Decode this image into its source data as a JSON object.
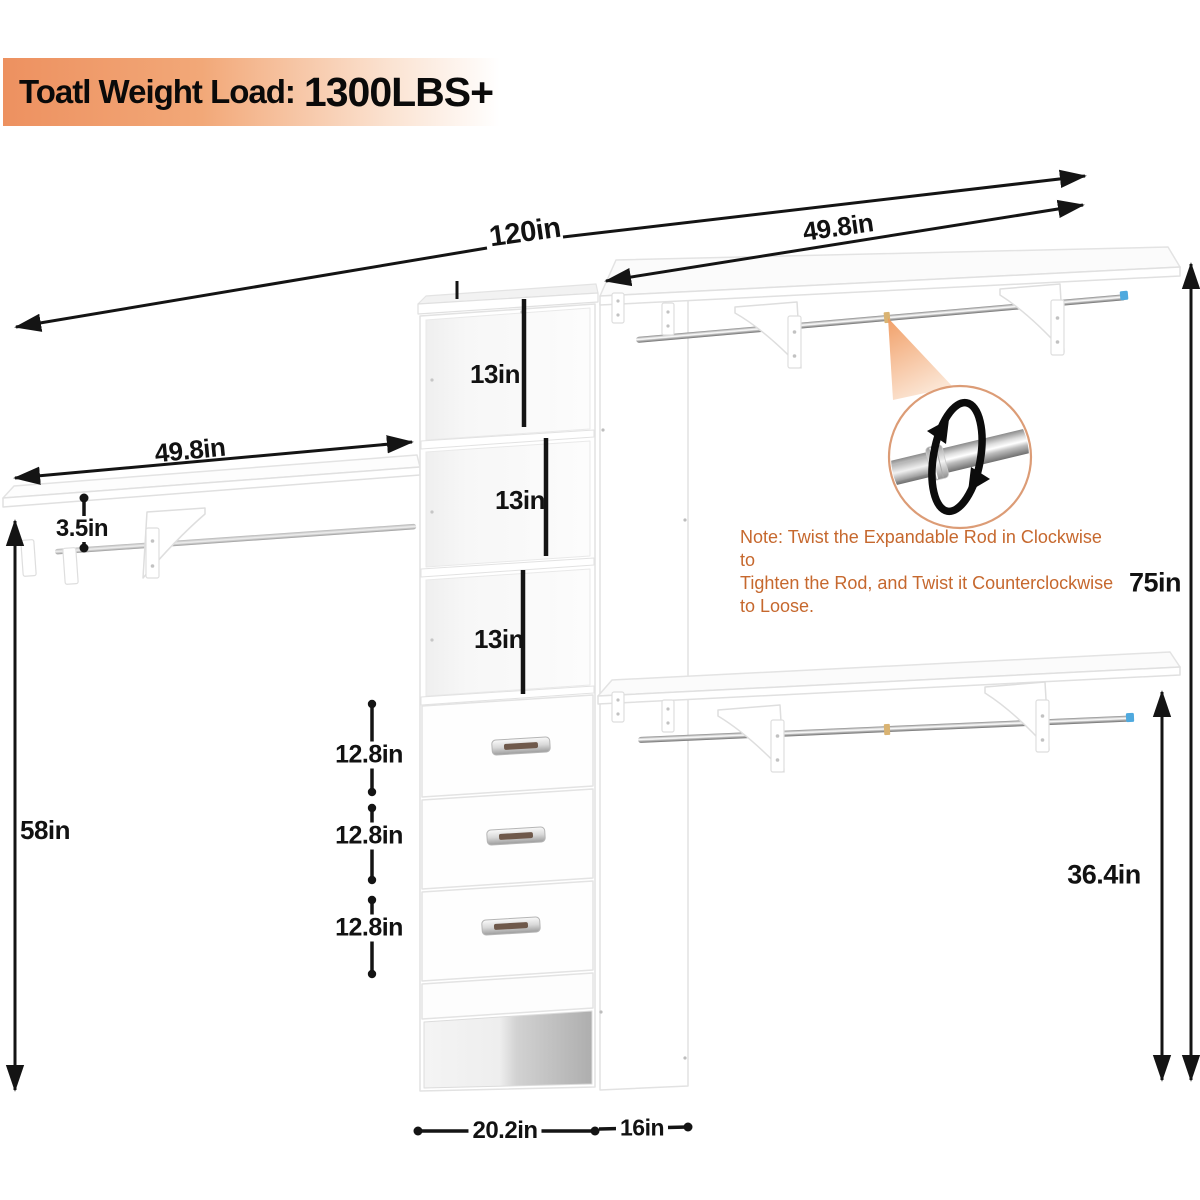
{
  "banner": {
    "label": "Toatl Weight Load:",
    "value": "1300LBS+"
  },
  "note": {
    "line1": "Note: Twist the Expandable Rod in Clockwise to",
    "line2": "Tighten the Rod, and Twist it Counterclockwise to Loose."
  },
  "dimensions": {
    "overall_width": "120in",
    "right_shelf_width": "49.8in",
    "left_shelf_width": "49.8in",
    "shelf_rod_gap": "3.5in",
    "cubby_heights": [
      "13in",
      "13in",
      "13in"
    ],
    "drawer_heights": [
      "12.8in",
      "12.8in",
      "12.8in"
    ],
    "left_height": "58in",
    "overall_height": "75in",
    "rod_height": "36.4in",
    "tower_width": "20.2in",
    "side_depth": "16in"
  },
  "colors": {
    "banner_orange": "#ED9160",
    "note_text": "#C6682E",
    "rod_cap_blue": "#4FA9DE",
    "inset_ring": "#DC9C76",
    "dimension_black": "#141414"
  }
}
